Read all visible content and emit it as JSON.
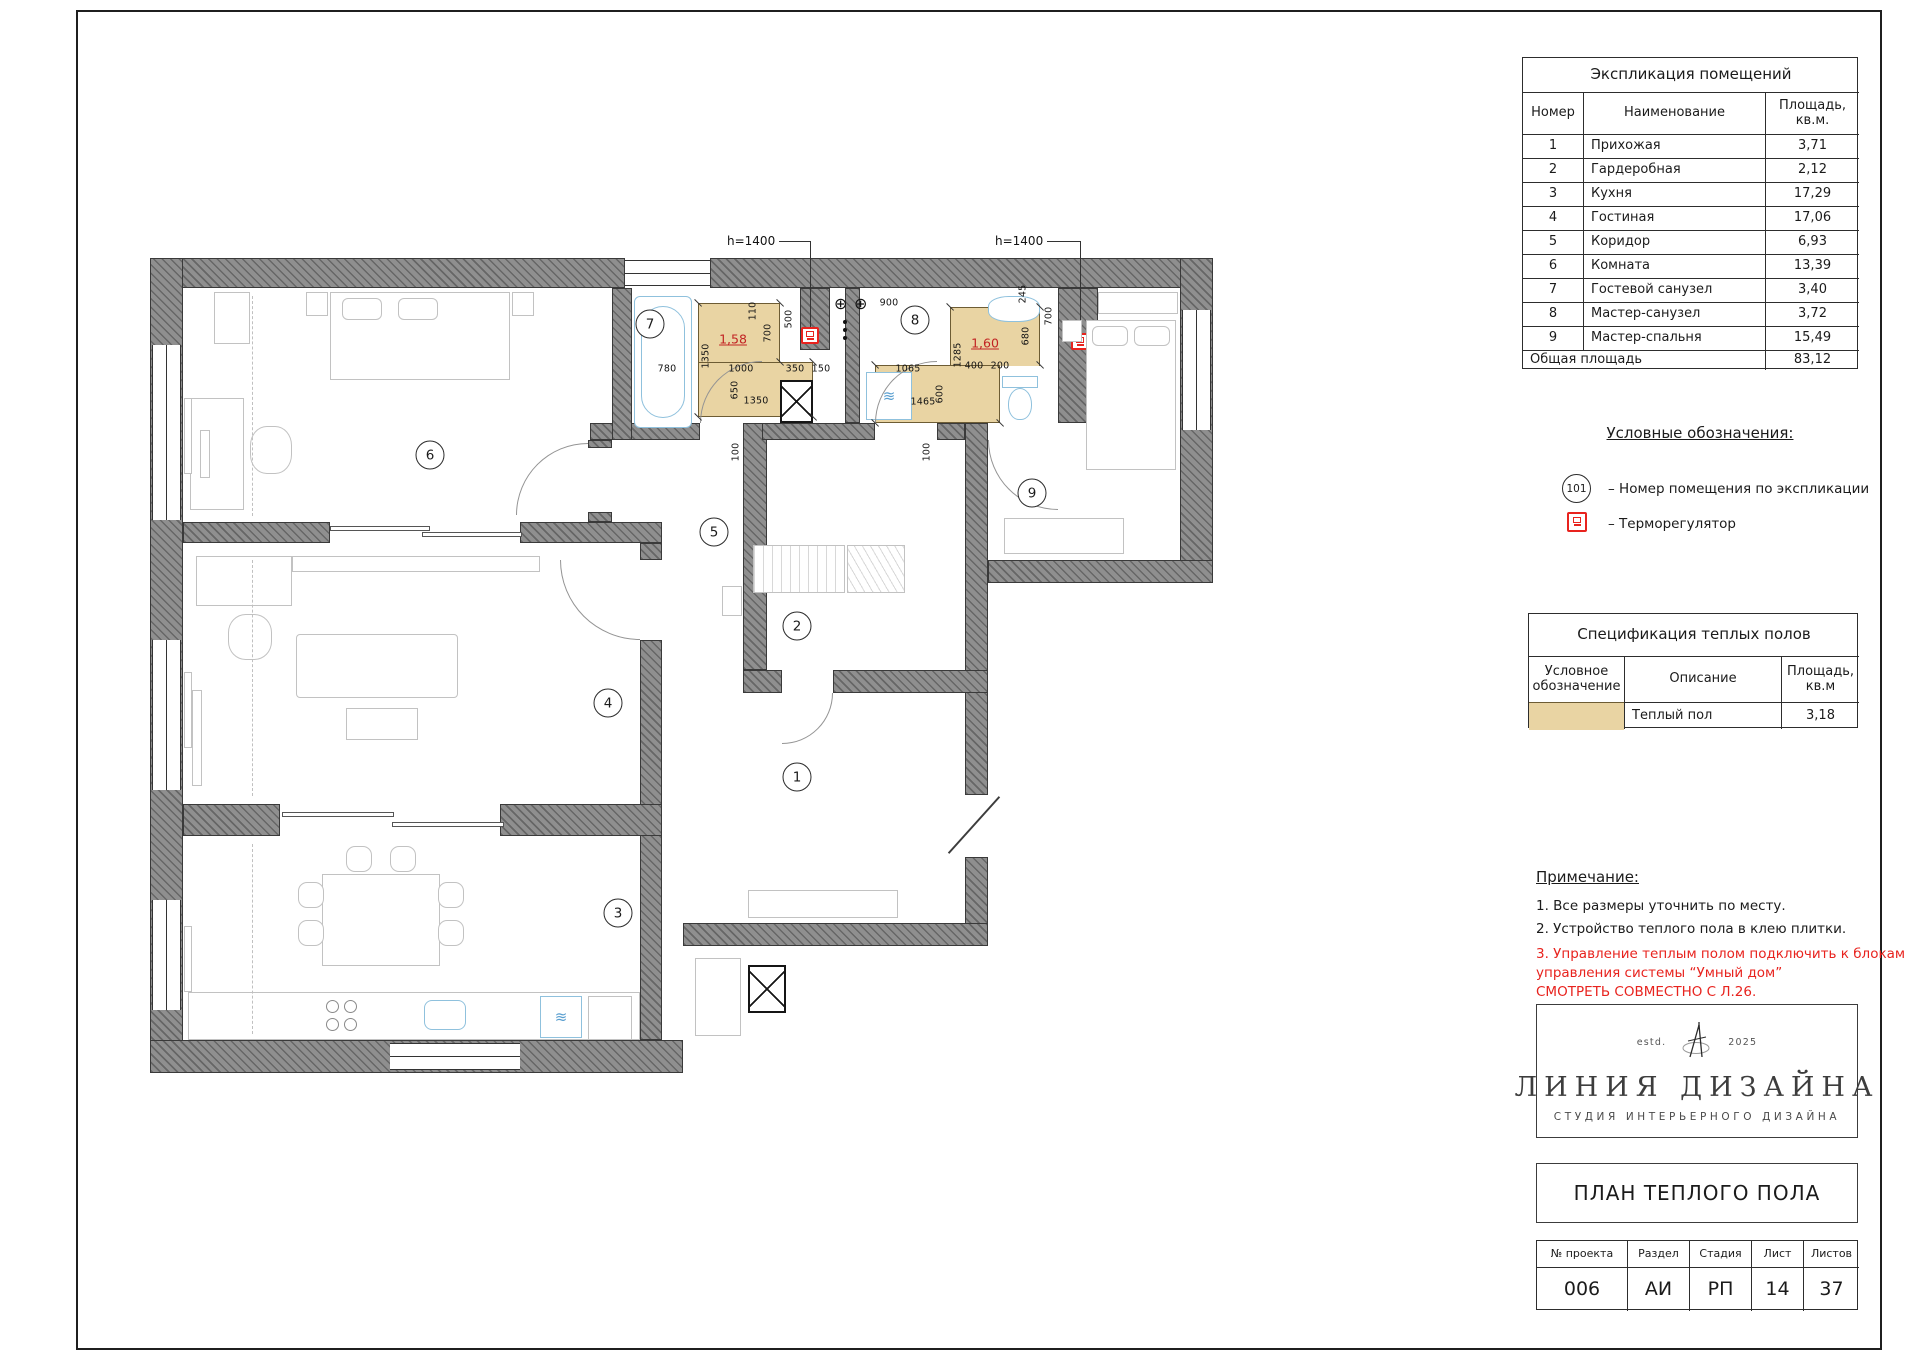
{
  "explication": {
    "title": "Экспликация помещений",
    "col_num": "Номер",
    "col_name": "Наименование",
    "col_area_1": "Площадь,",
    "col_area_2": "кв.м.",
    "rows": [
      {
        "num": "1",
        "name": "Прихожая",
        "area": "3,71"
      },
      {
        "num": "2",
        "name": "Гардеробная",
        "area": "2,12"
      },
      {
        "num": "3",
        "name": "Кухня",
        "area": "17,29"
      },
      {
        "num": "4",
        "name": "Гостиная",
        "area": "17,06"
      },
      {
        "num": "5",
        "name": "Коридор",
        "area": "6,93"
      },
      {
        "num": "6",
        "name": "Комната",
        "area": "13,39"
      },
      {
        "num": "7",
        "name": "Гостевой санузел",
        "area": "3,40"
      },
      {
        "num": "8",
        "name": "Мастер-санузел",
        "area": "3,72"
      },
      {
        "num": "9",
        "name": "Мастер-спальня",
        "area": "15,49"
      }
    ],
    "total_label": "Общая площадь",
    "total_value": "83,12"
  },
  "legend": {
    "title": "Условные обозначения:",
    "item1_symbol": "101",
    "item1_text": "– Номер помещения по экспликации",
    "item2_text": "– Терморегулятор"
  },
  "spec": {
    "title": "Спецификация теплых полов",
    "col_symbol_1": "Условное",
    "col_symbol_2": "обозначение",
    "col_desc": "Описание",
    "col_area_1": "Площадь,",
    "col_area_2": "кв.м",
    "row_desc": "Теплый пол",
    "row_area": "3,18",
    "swatch_color": "#e9d4a3"
  },
  "notes": {
    "title": "Примечание:",
    "line1": "1.   Все размеры уточнить по месту.",
    "line2": "2.   Устройство теплого пола в клею плитки.",
    "red1": "3. Управление теплым полом подключить к блокам",
    "red2": "управления системы “Умный дом”",
    "red3": "СМОТРЕТЬ СОВМЕСТНО С Л.26.",
    "red_color": "#e8231e"
  },
  "logo": {
    "estd": "estd.",
    "year": "2025",
    "name": "ЛИНИЯ ДИЗАЙНА",
    "subtitle": "СТУДИЯ ИНТЕРЬЕРНОГО ДИЗАЙНА"
  },
  "sheet": {
    "title": "ПЛАН ТЕПЛОГО ПОЛА"
  },
  "stamp": {
    "h1": "№ проекта",
    "h2": "Раздел",
    "h3": "Стадия",
    "h4": "Лист",
    "h5": "Листов",
    "v1": "006",
    "v2": "АИ",
    "v3": "РП",
    "v4": "14",
    "v5": "37"
  },
  "plan": {
    "warm_color": "#e9d4a3",
    "thermostat_color": "#e8231e",
    "warm_floor_1": "1,58",
    "warm_floor_2": "1,60",
    "height_label_1": "h=1400",
    "height_label_2": "h=1400",
    "rooms": [
      {
        "n": "1",
        "x": 797,
        "y": 777
      },
      {
        "n": "2",
        "x": 797,
        "y": 626
      },
      {
        "n": "3",
        "x": 618,
        "y": 913
      },
      {
        "n": "4",
        "x": 608,
        "y": 703
      },
      {
        "n": "5",
        "x": 714,
        "y": 532
      },
      {
        "n": "6",
        "x": 430,
        "y": 455
      },
      {
        "n": "7",
        "x": 650,
        "y": 324
      },
      {
        "n": "8",
        "x": 915,
        "y": 320
      },
      {
        "n": "9",
        "x": 1032,
        "y": 493
      }
    ],
    "dims": [
      {
        "t": "780",
        "x": 667,
        "y": 369,
        "r": 0
      },
      {
        "t": "1350",
        "x": 706,
        "y": 356,
        "r": 1
      },
      {
        "t": "1000",
        "x": 741,
        "y": 369,
        "r": 0
      },
      {
        "t": "350",
        "x": 795,
        "y": 369,
        "r": 0
      },
      {
        "t": "150",
        "x": 821,
        "y": 369,
        "r": 0
      },
      {
        "t": "110",
        "x": 753,
        "y": 311,
        "r": 1
      },
      {
        "t": "700",
        "x": 768,
        "y": 333,
        "r": 1
      },
      {
        "t": "500",
        "x": 789,
        "y": 319,
        "r": 1
      },
      {
        "t": "650",
        "x": 735,
        "y": 390,
        "r": 1
      },
      {
        "t": "1350",
        "x": 756,
        "y": 401,
        "r": 0
      },
      {
        "t": "100",
        "x": 736,
        "y": 452,
        "r": 1
      },
      {
        "t": "1285",
        "x": 958,
        "y": 355,
        "r": 1
      },
      {
        "t": "1065",
        "x": 908,
        "y": 369,
        "r": 0
      },
      {
        "t": "1465",
        "x": 923,
        "y": 402,
        "r": 0
      },
      {
        "t": "400",
        "x": 974,
        "y": 366,
        "r": 0
      },
      {
        "t": "200",
        "x": 1000,
        "y": 366,
        "r": 0
      },
      {
        "t": "600",
        "x": 940,
        "y": 394,
        "r": 1
      },
      {
        "t": "680",
        "x": 1026,
        "y": 336,
        "r": 1
      },
      {
        "t": "700",
        "x": 1049,
        "y": 316,
        "r": 1
      },
      {
        "t": "245",
        "x": 1023,
        "y": 294,
        "r": 1
      },
      {
        "t": "900",
        "x": 889,
        "y": 303,
        "r": 0
      },
      {
        "t": "100",
        "x": 927,
        "y": 452,
        "r": 1
      }
    ],
    "ticks": [
      [
        698,
        303
      ],
      [
        780,
        303
      ],
      [
        698,
        417
      ],
      [
        813,
        417
      ],
      [
        780,
        362
      ],
      [
        813,
        362
      ],
      [
        950,
        307
      ],
      [
        1040,
        307
      ],
      [
        875,
        365
      ],
      [
        1000,
        423
      ],
      [
        875,
        423
      ],
      [
        1040,
        365
      ]
    ]
  }
}
